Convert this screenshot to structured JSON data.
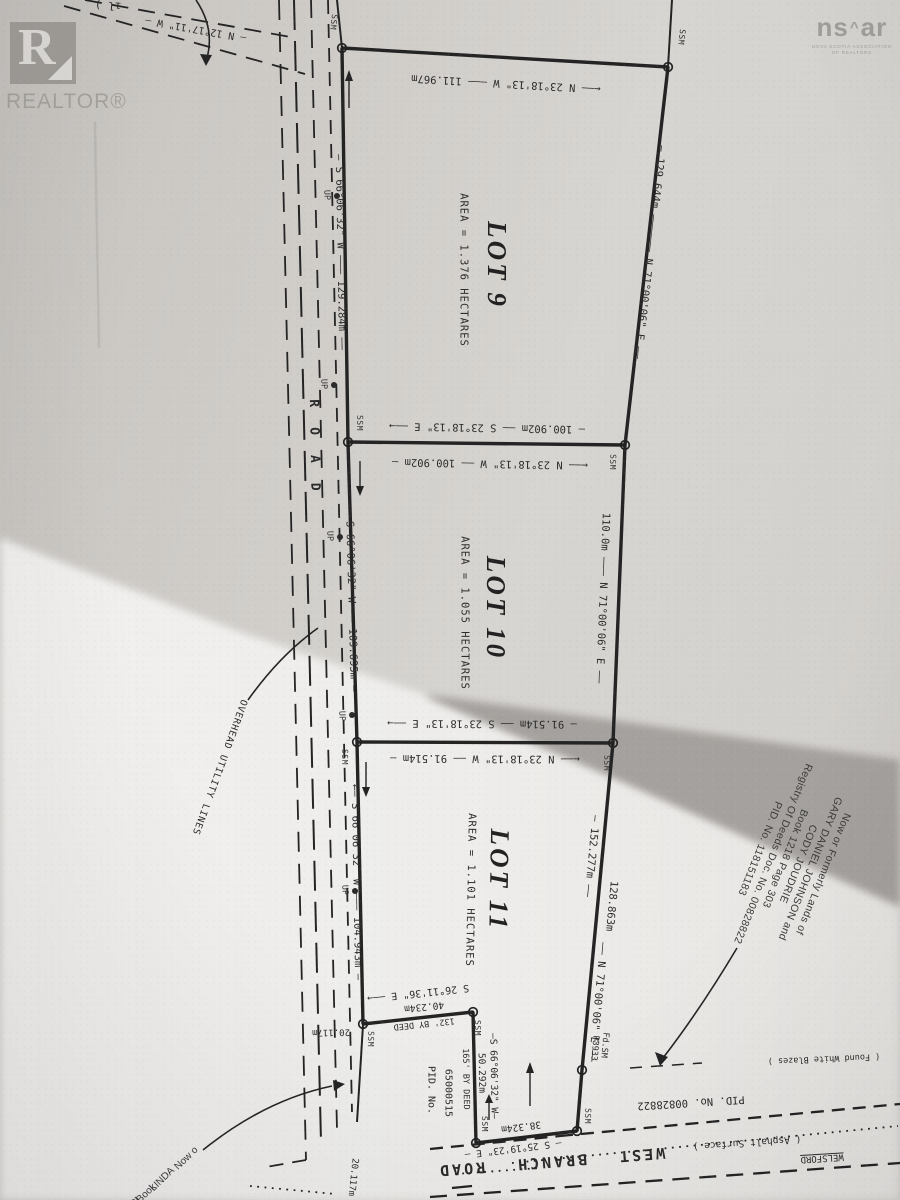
{
  "branding": {
    "realtor": "REALTOR®",
    "realtor_r": "R",
    "nsar_ns": "ns",
    "nsar_roof": "^",
    "nsar_ar": "ar",
    "nsar_sub1": "NOVA SCOTIA ASSOCIATION",
    "nsar_sub2": "OF REALTORS"
  },
  "lots": [
    {
      "name": "LOT 9",
      "area": "AREA = 1.376 HECTARES"
    },
    {
      "name": "LOT 10",
      "area": "AREA = 1.055 HECTARES"
    },
    {
      "name": "LOT 11",
      "area": "AREA = 1.101 HECTARES"
    }
  ],
  "bearings": {
    "top_road": "— N 12°17'11\" W —",
    "top_frag": "ıl )",
    "lot9_top": "←—— N 23°18'13\" W ——— 111.967m",
    "lot9_west": "— S 66°06'32\" W ——— 129.284m ——",
    "lot9_east": "— 129.644m —————— N 71°00'06\" E ——",
    "div910_s": "— 100.902m —— S 23°18'13\" E ——→",
    "div910_n": "←—— N 23°18'13\" W —— 100.902m —",
    "lot10_west": "— S 66°06'32\" W —— 109.695m —",
    "lot10_east": "110.0m ——— N 71°00'06\" E ——",
    "div1011_s": "— 91.514m —— S 23°18'13\" E ——→",
    "div1011_n": "←—— N 23°18'13\" W —— 91.514m —",
    "lot11_west": "←— S 66°06'32\" W ——— 104.943m —",
    "lot11_east_1": "— 152.277m ——",
    "lot11_east_2": "128.863m",
    "lot11_east_3": "—— N 71°00'06\" E ——",
    "s2611": "S 26°11'36\" E ——→",
    "d40234": "40.234m",
    "deed132": "132' BY DEED",
    "d20117": "20.117m",
    "d20117b": "20.117m",
    "s6606s": "—S 66°06'32\" W—",
    "d50292": "50.292m",
    "deed165": "165' BY DEED",
    "d38324": "38.324m",
    "s2519": "— S 25°19'23\" E —"
  },
  "markers": {
    "ssm": "SSM",
    "up": "UP",
    "fdsm": "Fd.SM",
    "fdsm2": "P3933"
  },
  "road": {
    "vertical": "ROAD",
    "west_branch": "WEST BRANCH ROAD",
    "asphalt": "( Asphalt Surface )",
    "welsford": "WELSFORD",
    "pid": "PID. No. 00828822",
    "blazes": "( Found White Blazes )",
    "overhead": "OVERHEAD UTILITY LINES"
  },
  "parcels": {
    "pid_label": "PID. No.",
    "pid_value": "65000515"
  },
  "neighbor_east": {
    "lines": [
      "Now or Formerly Lands of",
      "GARY DANIEL JOHNSON and",
      "CODY JOUDRIE",
      "Book 1218 Page 303",
      "Registry Of Deeds Doc. No. 00828822",
      "PID. No. 118151183"
    ]
  },
  "neighbor_sw": {
    "lines": [
      "Now o",
      "LINDA",
      "Book",
      "PI"
    ]
  }
}
